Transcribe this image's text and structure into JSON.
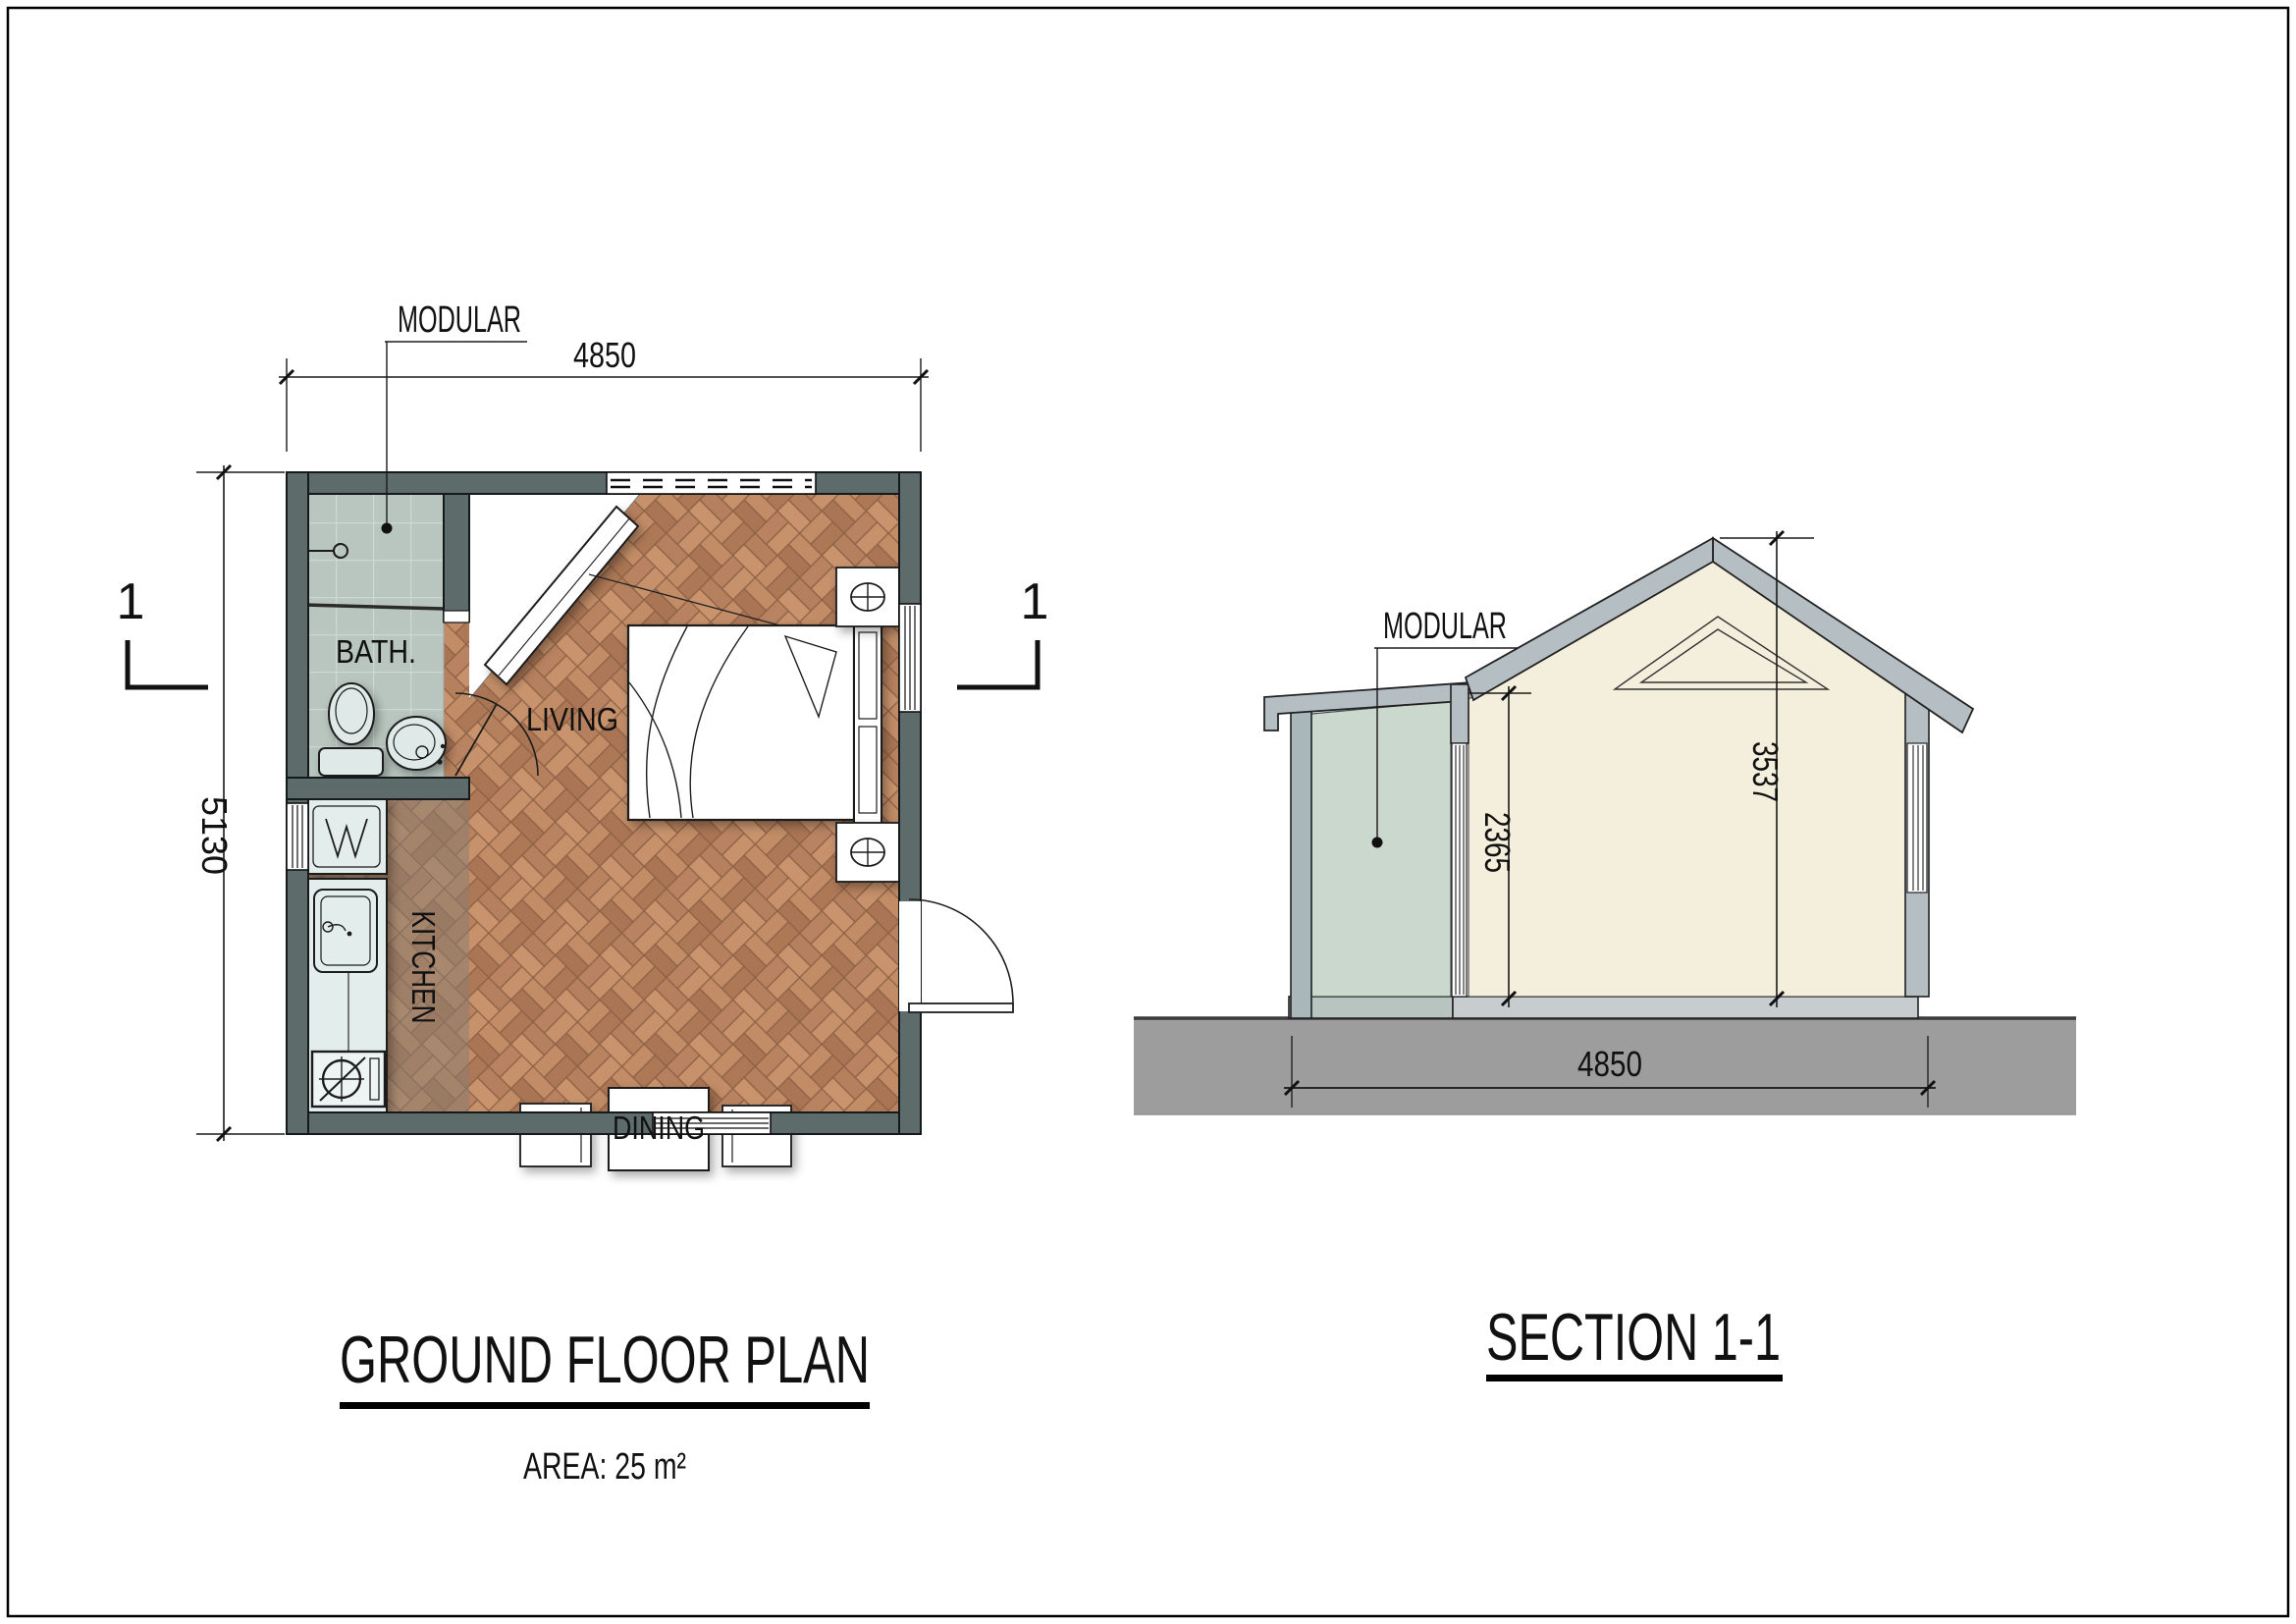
{
  "document": {
    "type": "architectural drawing",
    "sheet_border_color": "#000000",
    "background": "#ffffff"
  },
  "floor_plan": {
    "title": "GROUND FLOOR PLAN",
    "subtitle": "AREA: 25 m²",
    "callout": "MODULAR",
    "section_marker": "1",
    "dimensions": {
      "width": "4850",
      "height": "5130"
    },
    "room_labels": {
      "bath": "BATH.",
      "living": "LIVING",
      "kitchen": "KITCHEN",
      "dining": "DINING"
    },
    "fixtures": [
      "shower-head",
      "toilet",
      "washbasin",
      "washing-machine",
      "kitchen-sink",
      "cooktop",
      "wardrobe",
      "double-bed",
      "nightstand-lamp",
      "dining-table",
      "chairs",
      "entrance-door",
      "windows"
    ],
    "colors": {
      "wall": "#5d6b6b",
      "bath_tile": "#b9c6bf",
      "parquet": "#b2805a",
      "kitchen_tint": "#8b7f72",
      "fixture_fill": "#dfeae8"
    }
  },
  "section_view": {
    "title": "SECTION 1-1",
    "callout": "MODULAR",
    "dimensions": {
      "module_height": "2365",
      "ridge_height": "3537",
      "width": "4850"
    },
    "colors": {
      "roof_wall": "#b5bec3",
      "interior": "#f4eedd",
      "module_interior": "#cbd8cd",
      "module_wall": "#a9b7bb",
      "ground": "#9d9d9d"
    }
  }
}
